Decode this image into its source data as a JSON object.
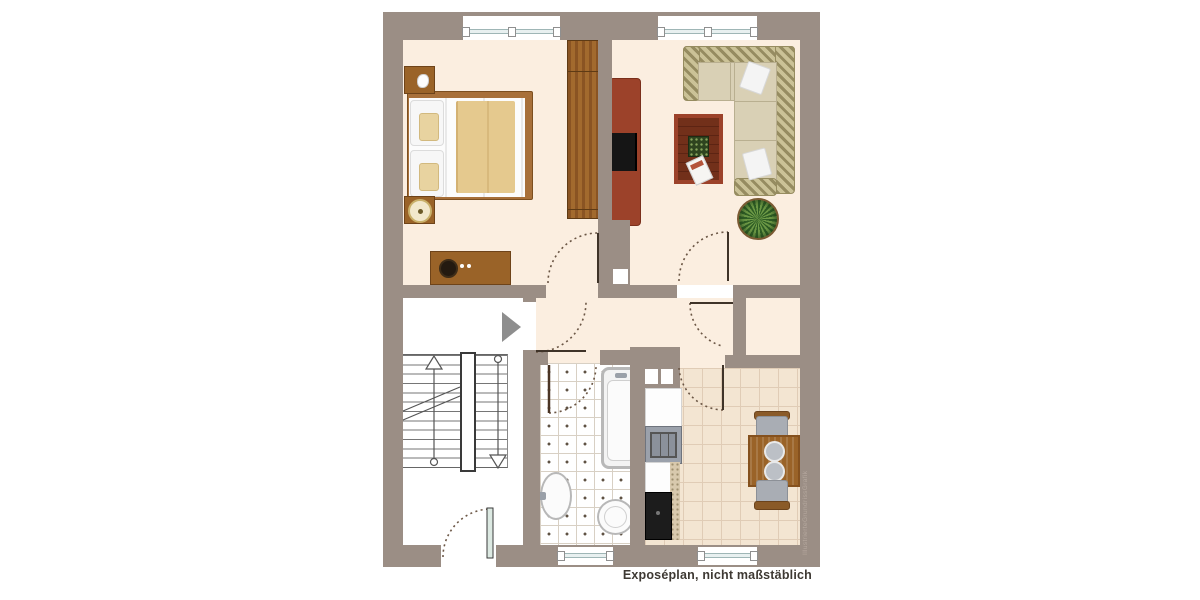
{
  "caption": {
    "text": "Exposéplan, nicht maßstäblich"
  },
  "watermark": {
    "text": "IllustrierteGrundrissGrafik"
  },
  "colors": {
    "wall": "#9b8e85",
    "floor_cream": "#fbeee0",
    "floor_white": "#ffffff",
    "tile_kitchen": "#f3e5d2",
    "wood": "#9a6328",
    "red_furniture": "#9c422a",
    "sofa_olive": "#b6ab7e",
    "sofa_seat": "#d9d0b5",
    "blanket_tan": "#e5c98e",
    "appliance_black": "#1c1c1c",
    "caption_color": "#3e3933",
    "watermark_color": "#b5a89e"
  },
  "plan": {
    "type": "apartment-floor-plan",
    "rooms": [
      {
        "name": "bedroom",
        "furniture": [
          "double-bed",
          "pillows",
          "blanket",
          "nightstand",
          "nightstand-lamp",
          "dresser",
          "wardrobe"
        ]
      },
      {
        "name": "living-room",
        "furniture": [
          "corner-sofa",
          "sofa-pillows",
          "coffee-table",
          "tv-sideboard",
          "floor-plant"
        ]
      },
      {
        "name": "hallway",
        "furniture": []
      },
      {
        "name": "stairwell",
        "furniture": [
          "staircase-double-run",
          "up-arrow",
          "down-arrow",
          "entry-direction-arrow",
          "building-entrance-door"
        ]
      },
      {
        "name": "bathroom",
        "furniture": [
          "bathtub",
          "washbasin",
          "toilet"
        ]
      },
      {
        "name": "kitchen",
        "furniture": [
          "kitchen-counter",
          "stove",
          "black-appliance",
          "dining-table",
          "two-chairs"
        ]
      }
    ],
    "windows": [
      "bedroom-window",
      "living-room-window",
      "bathroom-window",
      "kitchen-window"
    ],
    "doors": [
      "apartment-entrance-door",
      "bedroom-door",
      "living-room-door",
      "hallway-door",
      "kitchen-door",
      "bathroom-door",
      "building-entrance-door"
    ]
  }
}
